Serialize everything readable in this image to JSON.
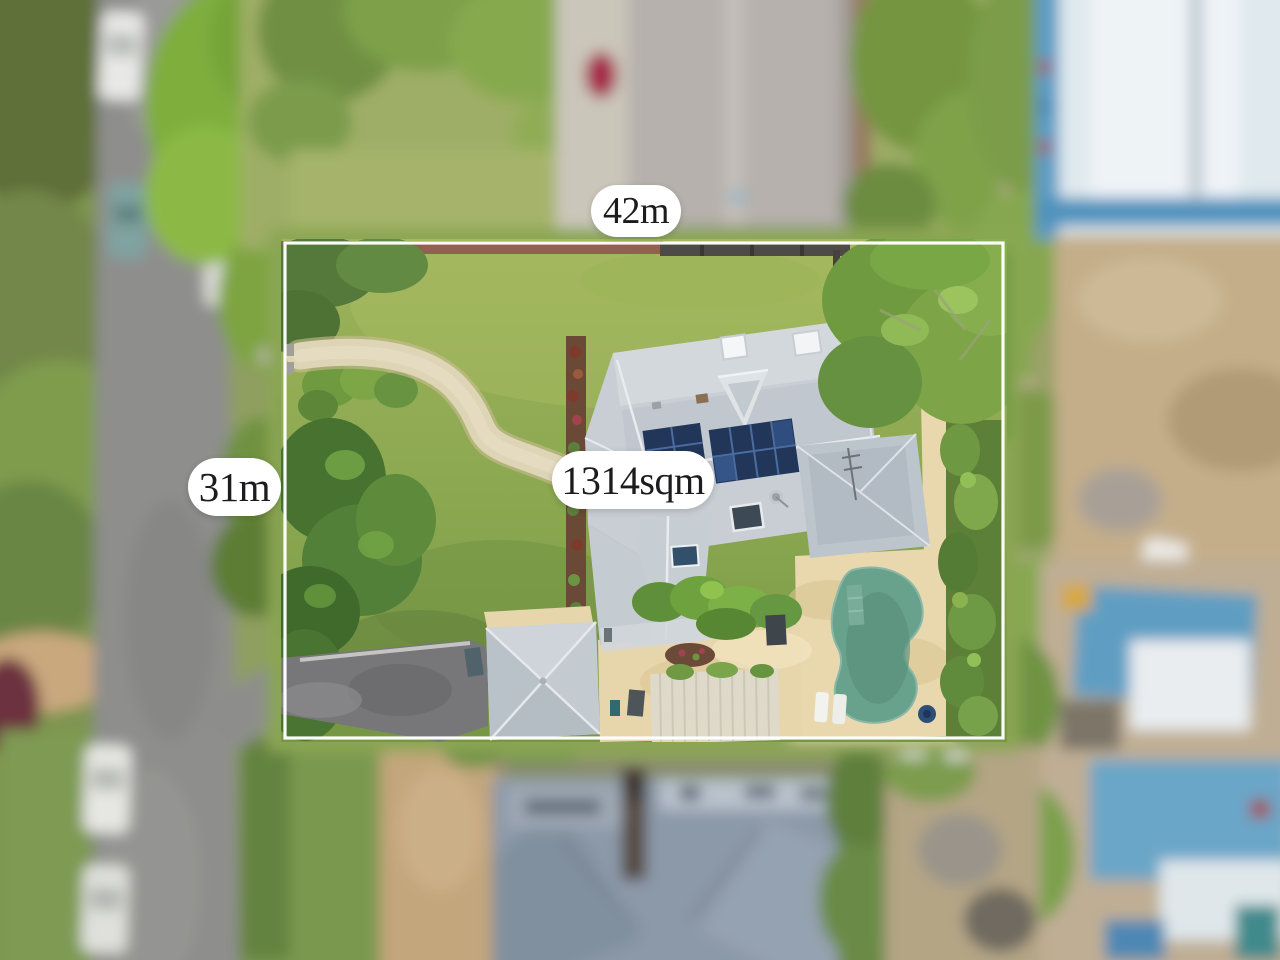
{
  "annotations": {
    "frontage": "42m",
    "side": "31m",
    "area": "1314sqm"
  },
  "colors": {
    "boundary_line": "#ffffff",
    "pill_background": "#ffffff",
    "pill_text": "#1c1c1e",
    "lawn": "#8aa750",
    "roof": "#c8ced4",
    "pool_water": "#68a28d",
    "paving": "#e9d8ae",
    "road": "#8e8e8c",
    "solar_panels": "#22365a",
    "neighbour_roof": "#8c99a9"
  },
  "scene_elements": [
    "lawn",
    "garden-path",
    "main-house-roof",
    "solar-panels",
    "skylights",
    "swimming-pool",
    "sun-loungers",
    "garage-roof",
    "pergola",
    "driveway",
    "hedges",
    "trees",
    "street-with-parked-cars",
    "neighbouring-roofs",
    "construction-site"
  ]
}
